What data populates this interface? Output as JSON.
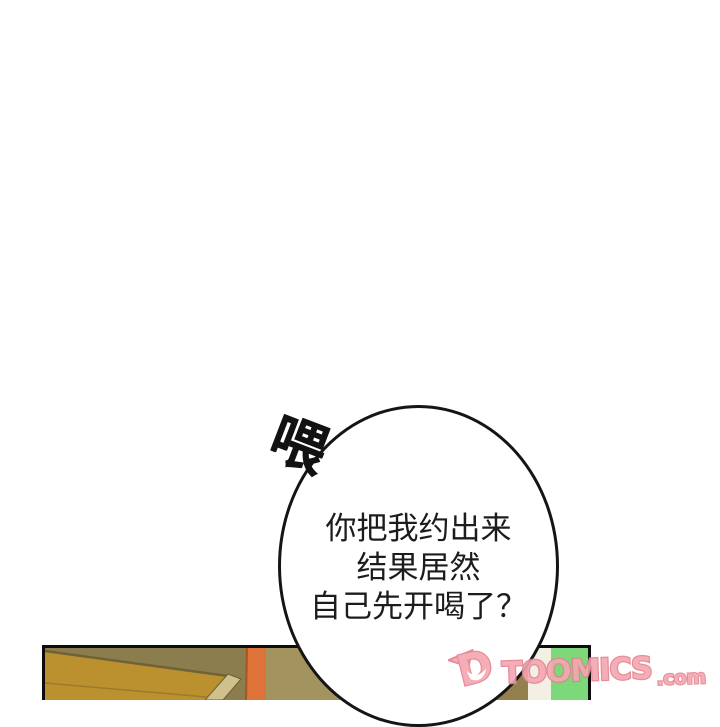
{
  "page": {
    "background_color": "#ffffff",
    "type": "webtoon-comic-page"
  },
  "speech_bubble": {
    "exclamation": "喂",
    "lines": [
      "你把我约出来",
      "结果居然",
      "自己先开喝了？"
    ],
    "fill_color": "#ffffff",
    "stroke_color": "#151515",
    "text_color": "#1c1c1c"
  },
  "panel": {
    "colors": {
      "border": "#0d0d0d",
      "frame_olive": "#8c7d4e",
      "door_gold": "#bb9130",
      "door_edge_tan": "#cfc08c",
      "orange_strip": "#dd7338",
      "orange_edge": "#a8541f",
      "wall_khaki": "#a3935f",
      "wall_khaki_light": "#a79a6b",
      "shadow_khaki": "#93804e",
      "white_stripe": "#f3efe5",
      "green_stripe": "#7cd878"
    }
  },
  "watermark": {
    "mark_letter": "D",
    "brand": "TOOMICS",
    "suffix": ".com",
    "fill_color": "#f4a6b0",
    "outline_color": "#e2828f"
  }
}
